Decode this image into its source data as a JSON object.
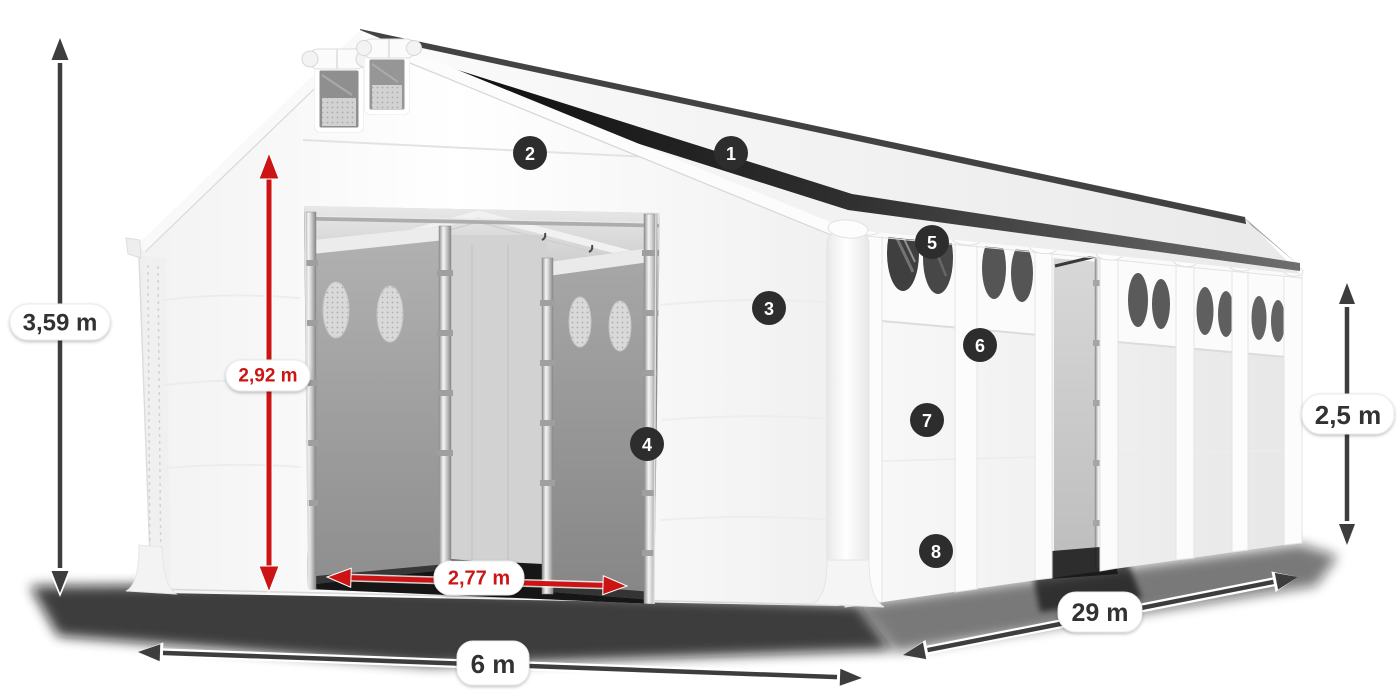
{
  "illustration": {
    "subject": "white storage tent technical product illustration",
    "badges": [
      {
        "number": "1"
      },
      {
        "number": "2"
      },
      {
        "number": "3"
      },
      {
        "number": "4"
      },
      {
        "number": "5"
      },
      {
        "number": "6"
      },
      {
        "number": "7"
      },
      {
        "number": "8"
      }
    ],
    "dimensions": {
      "total_height": {
        "value": "3,59 m"
      },
      "entrance_height": {
        "value": "2,92 m"
      },
      "entrance_width": {
        "value": "2,77 m"
      },
      "front_width": {
        "value": "6 m"
      },
      "side_length": {
        "value": "29 m"
      },
      "wall_height": {
        "value": "2,5 m"
      }
    },
    "colors": {
      "dimension_arrow_dark": "#3d3d3d",
      "dimension_arrow_red": "#cc1414",
      "badge_background": "#2d2d2d",
      "tent_surface": "#f7f7f7",
      "interior_gray": "#9e9e9e"
    }
  }
}
